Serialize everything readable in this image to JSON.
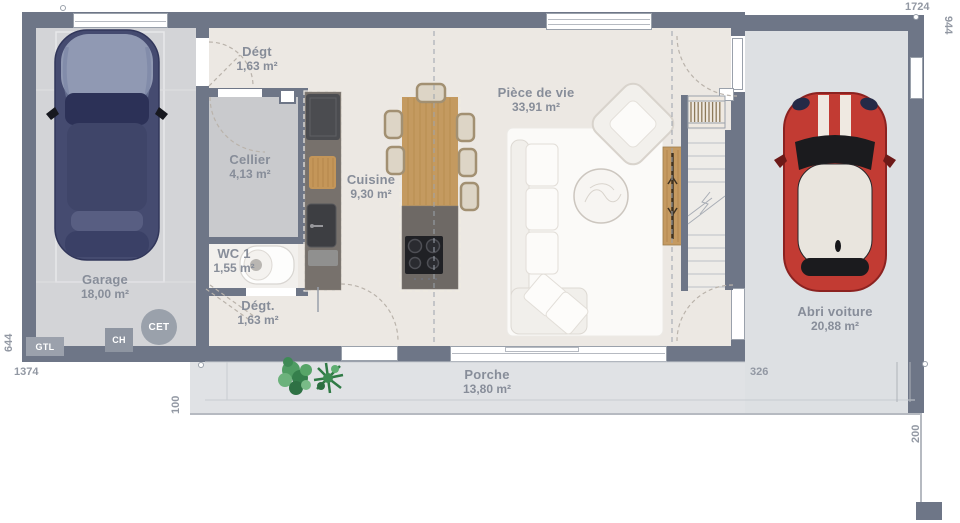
{
  "plan": {
    "title": "Plan de maison - rez-de-chaussée",
    "rooms": [
      {
        "name": "Dégt",
        "area": "1,63 m²"
      },
      {
        "name": "Cellier",
        "area": "4,13 m²"
      },
      {
        "name": "WC 1",
        "area": "1,55 m²"
      },
      {
        "name": "Dégt.",
        "area": "1,63 m²"
      },
      {
        "name": "Cuisine",
        "area": "9,30 m²"
      },
      {
        "name": "Pièce de vie",
        "area": "33,91 m²"
      },
      {
        "name": "Garage",
        "area": "18,00 m²"
      },
      {
        "name": "Abri voiture",
        "area": "20,88 m²"
      },
      {
        "name": "Porche",
        "area": "13,80 m²"
      }
    ],
    "equipment": [
      {
        "label": "GTL"
      },
      {
        "label": "CH"
      },
      {
        "label": "CET"
      }
    ],
    "dimensions": {
      "top": "1724",
      "right": "944",
      "left": "644",
      "bottom": "1374",
      "porch_depth": "100",
      "abri_width": "326",
      "right_lower": "200"
    },
    "colors": {
      "wall": "#6e7687",
      "house_floor": "#ece8e3",
      "garage_floor": "#d3d4d7",
      "cellier_floor": "#c9cacd",
      "outdoor_floor": "#dfe1e4",
      "wood": "#c49a60",
      "car_blue": "#454b70",
      "car_red": "#c23b33",
      "label_text": "#878d99",
      "dimension_text": "#9298a3"
    }
  }
}
